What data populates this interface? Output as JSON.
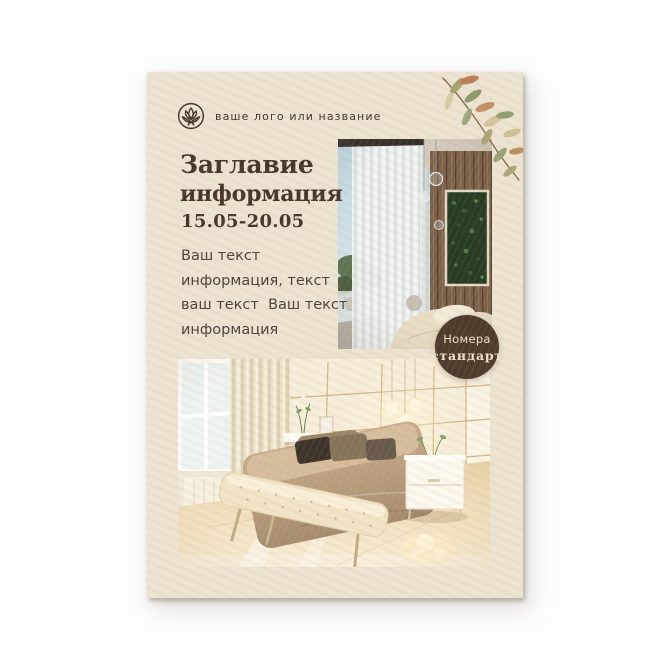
{
  "canvas": {
    "background": "#fdfdfd"
  },
  "poster": {
    "background_color": "#ece3d0",
    "brand": {
      "logo_icon": "lotus-icon",
      "name_placeholder": "ваше лого или название"
    },
    "title": {
      "line1": "Заглавие",
      "line2": "информация"
    },
    "date_range": "15.05-20.05",
    "body_lines": [
      "Ваш текст",
      "информация, текст",
      "ваш текст  Ваш текст",
      "информация"
    ],
    "badge": {
      "line1": "Номера",
      "line2": "стандарт",
      "background": "#4d3b2b",
      "text_color": "#eee3cd"
    },
    "photos": {
      "top_alt": "hotel bedroom with sheer curtains, wood slat wall and green plant panel",
      "bottom_alt": "bedroom with paneled headboard wall, beige bed, tufted bench and glossy floor"
    },
    "decor": {
      "branch_icon": "watercolor-leaf-branch"
    },
    "colors": {
      "title_text": "#46362a",
      "body_text": "#4b443a",
      "logo_text": "#3f352b"
    }
  }
}
